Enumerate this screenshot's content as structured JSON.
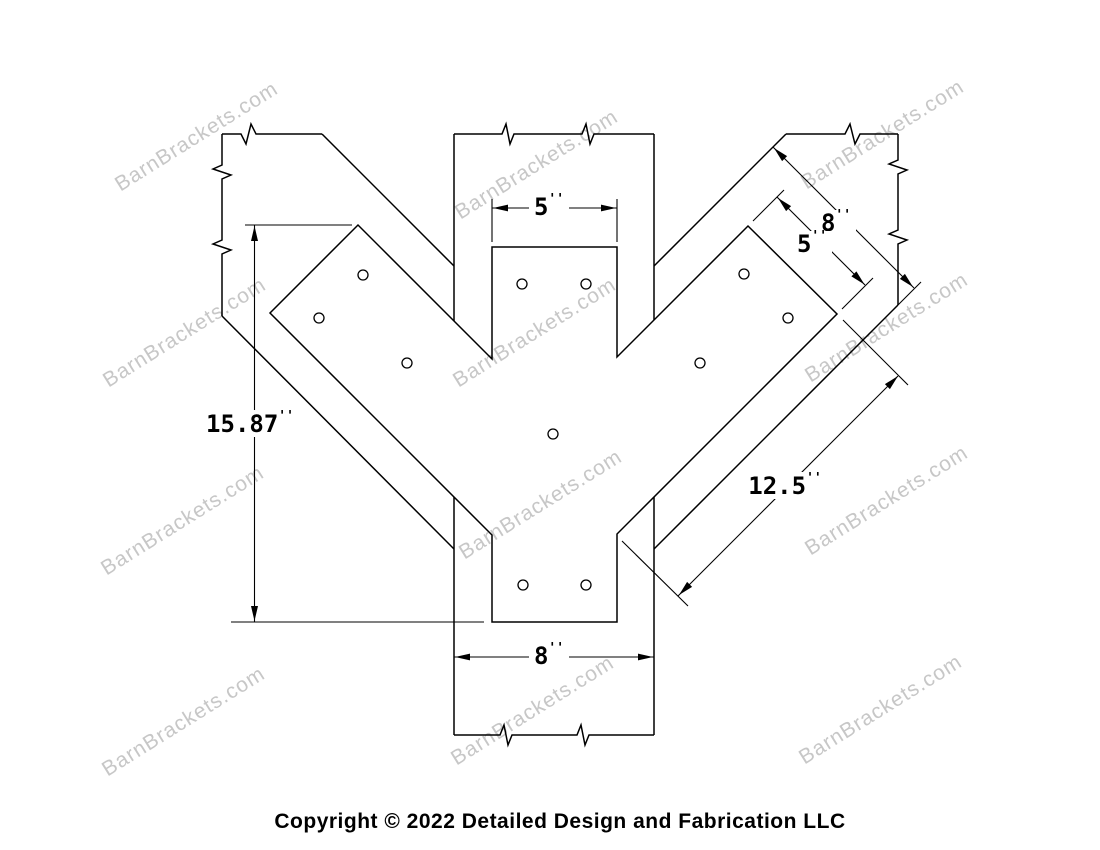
{
  "drawing": {
    "watermark": {
      "text": "BarnBrackets.com",
      "color": "#c7c7c7"
    },
    "copyright": "Copyright © 2022 Detailed Design and Fabrication LLC",
    "colors": {
      "line": "#000000",
      "background": "#ffffff"
    },
    "dimensions": {
      "top_plate_width": {
        "value": "5",
        "unit": "''"
      },
      "overall_height": {
        "value": "15.87",
        "unit": "''"
      },
      "post_width": {
        "value": "8",
        "unit": "''"
      },
      "brace_width": {
        "value": "8",
        "unit": "''"
      },
      "brace_plate_width": {
        "value": "5",
        "unit": "''"
      },
      "brace_plate_length": {
        "value": "12.5",
        "unit": "''"
      }
    }
  }
}
